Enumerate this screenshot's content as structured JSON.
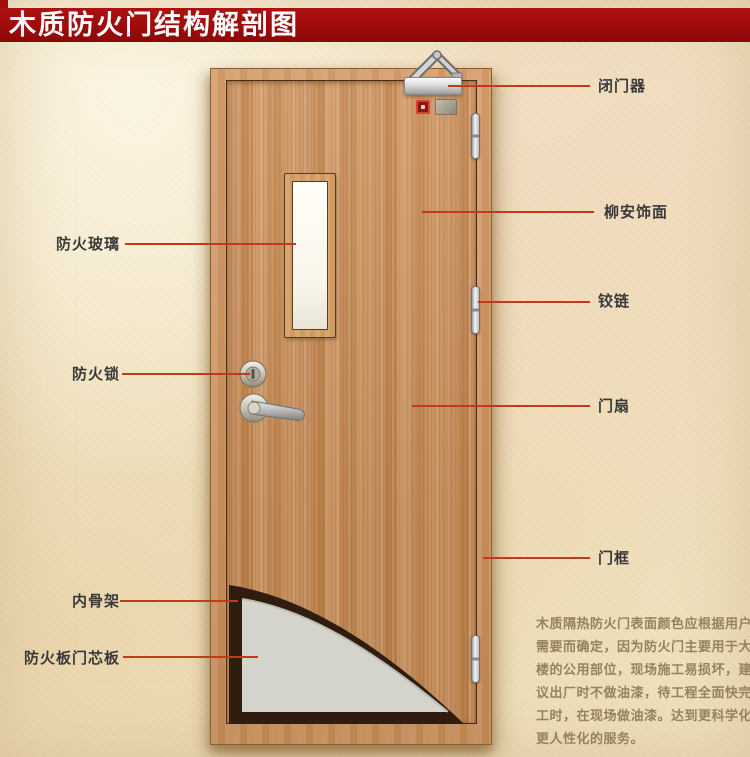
{
  "page": {
    "title": "木质防火门结构解剖图"
  },
  "colors": {
    "banner_red": "#a30d0d",
    "leader_line": "#c13a1a",
    "parchment_bg": "#f3e6c8",
    "leaf_wood": "#c98e5c",
    "frame_wood": "#cd9463",
    "core_gray": "#d5d4cc",
    "skeleton_dark": "#2f1d0f",
    "label_text": "#3a3a3a",
    "note_text": "#95835d"
  },
  "callouts": {
    "left": [
      {
        "id": "fire-glass",
        "label": "防火玻璃"
      },
      {
        "id": "fire-lock",
        "label": "防火锁"
      },
      {
        "id": "inner-skeleton",
        "label": "内骨架"
      },
      {
        "id": "fire-board-core",
        "label": "防火板门芯板"
      }
    ],
    "right": [
      {
        "id": "door-closer",
        "label": "闭门器"
      },
      {
        "id": "lauan-veneer",
        "label": "柳安饰面"
      },
      {
        "id": "hinge",
        "label": "铰链"
      },
      {
        "id": "door-leaf",
        "label": "门扇"
      },
      {
        "id": "door-frame",
        "label": "门框"
      }
    ]
  },
  "note": {
    "lines": [
      "木质隔热防火门表面颜色应根据用户",
      "需要而确定，因为防火门主要用于大",
      "楼的公用部位，现场施工易损坏，建",
      "议出厂时不做油漆，待工程全面快完",
      "工时，在现场做油漆。达到更科学化",
      "更人性化的服务。"
    ]
  }
}
